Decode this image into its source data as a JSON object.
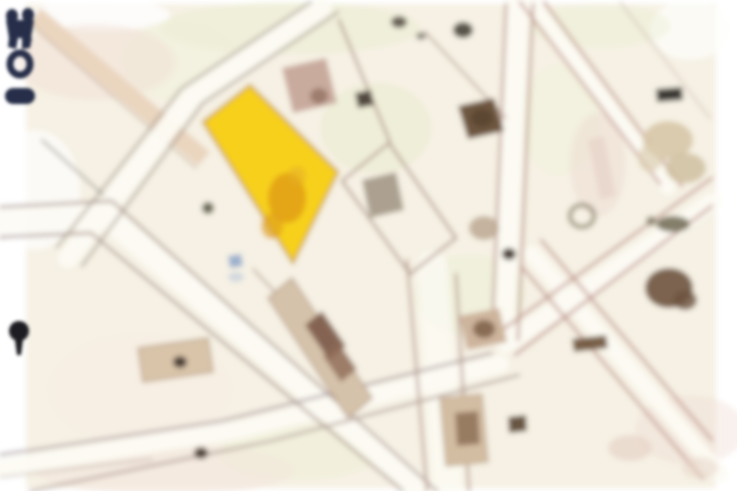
{
  "map": {
    "kind": "blurred-parcel-map",
    "background_color": "#f6f1e4",
    "margin_color": "#ffffff",
    "street_fill": "#fdfbf4",
    "line_color": "#a8887c",
    "tan_road_fill": "#ead5bf",
    "highlighted_parcel": {
      "fill": "#f7d01e",
      "outline": "#c9a02a",
      "marking_color": "#de9b18"
    },
    "building_fill": "#d5c2aa",
    "building_dark_fill": "#7c5a48",
    "tint_green": "#e9eecf",
    "tint_pink": "#f2e0d5"
  },
  "markers": {
    "emblem_color": "#262d49",
    "ring_color": "#262d49",
    "bar_color": "#262d49",
    "pin_color": "#1d1b22"
  }
}
